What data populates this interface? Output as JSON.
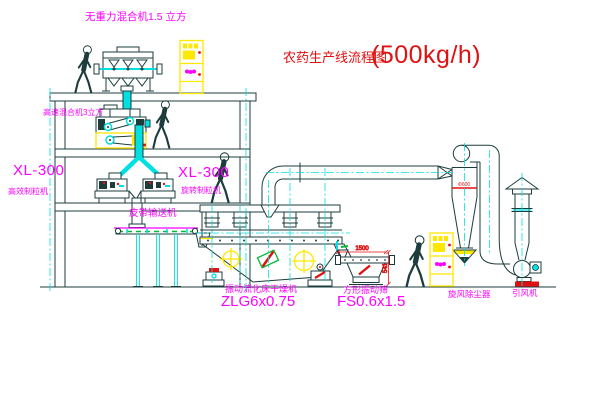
{
  "colors": {
    "line": "#1d3d3d",
    "cyan": "#00e0e0",
    "magenta": "#ff00ff",
    "red": "#e01111",
    "yellow": "#ffe800",
    "green": "#00bb33",
    "bg": "#ffffff"
  },
  "title": {
    "name": "农药生产线流程图",
    "capacity": "(500kg/h)"
  },
  "equipment": {
    "gravity_mixer_label": "无重力混合机1.5 立方",
    "high_speed_mixer_label": "高速混合机3立方",
    "left_granulator_model": "XL-300",
    "left_granulator_name": "高效制粒机",
    "right_granulator_model": "XL-300",
    "right_granulator_name": "旋转制粒机",
    "belt_conveyor_label": "皮带输送机",
    "dryer_label": "振动流化床干燥机",
    "dryer_model": "ZLG6x0.75",
    "sieve_label": "方形振动筛",
    "sieve_model": "FS0.6x1.5",
    "cyclone_label": "旋风除尘器",
    "fan_label": "引风机"
  },
  "dimensions": {
    "sieve_width": "1500",
    "sieve_height": "541",
    "cyclone_note": "Φ600"
  }
}
